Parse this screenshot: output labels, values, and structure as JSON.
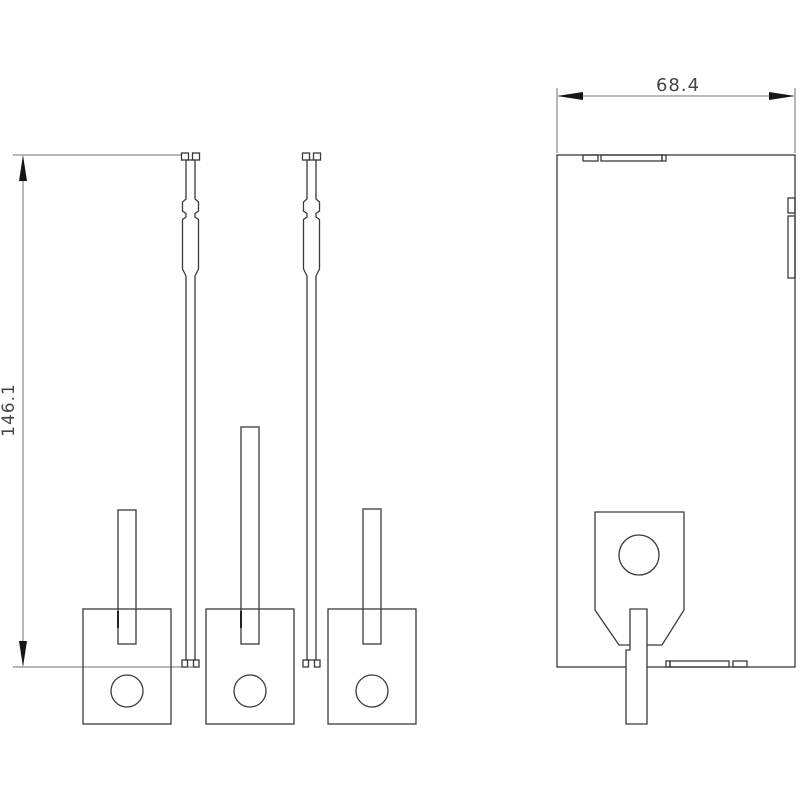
{
  "drawing": {
    "height_dimension": {
      "label": "146.1"
    },
    "width_dimension": {
      "label": "68.4"
    },
    "colors": {
      "background": "#ffffff",
      "outline": "#3a3a3a",
      "dimension_line": "#707070",
      "arrow": "#151515",
      "label_text": "#454545"
    }
  }
}
